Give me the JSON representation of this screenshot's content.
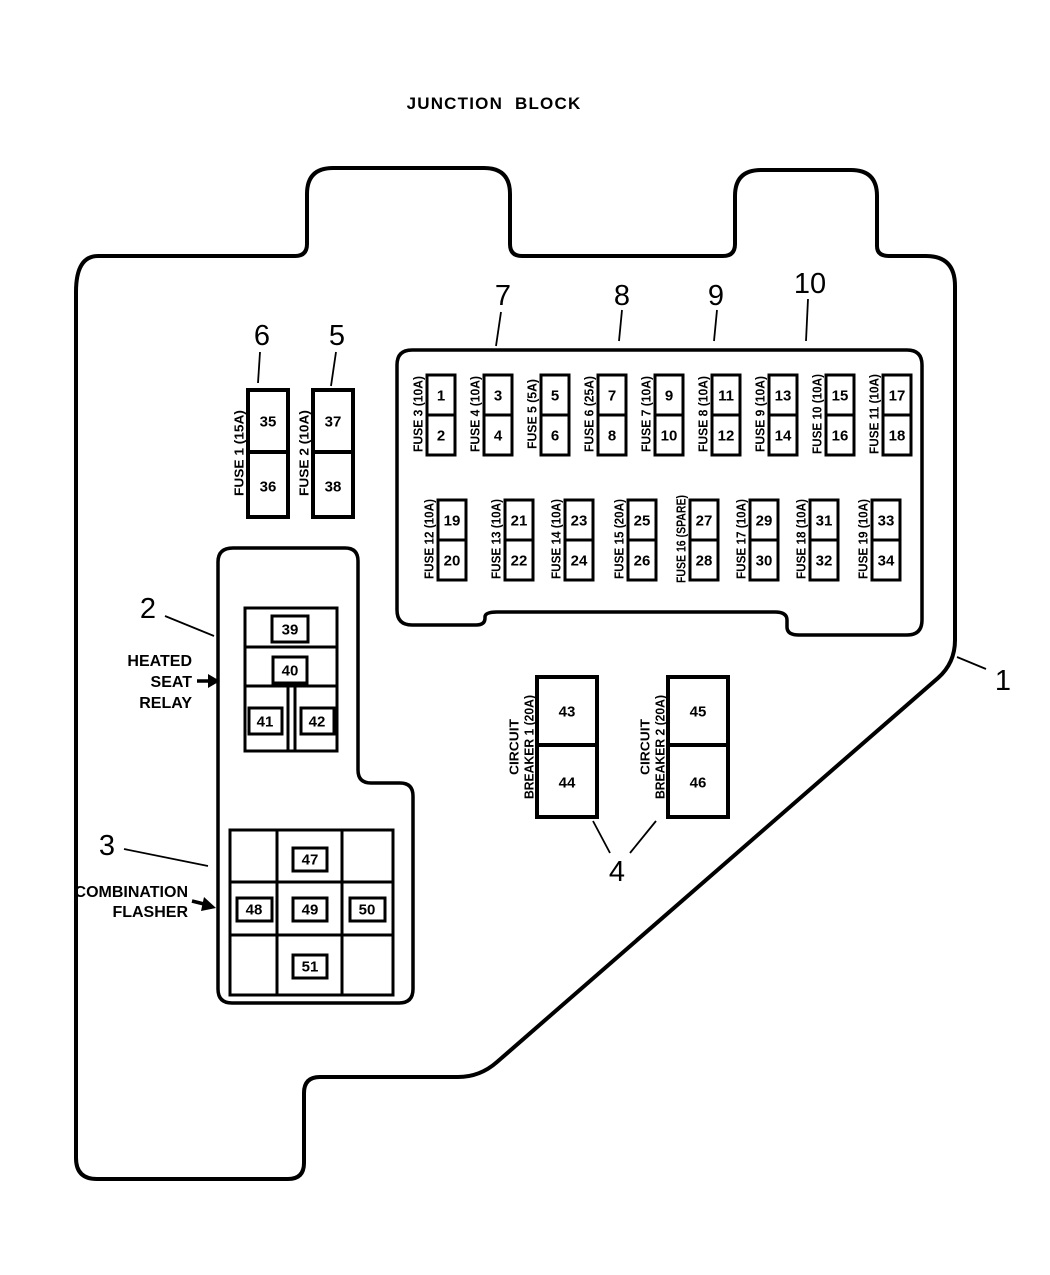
{
  "title": "JUNCTION BLOCK",
  "callouts": {
    "c1": "1",
    "c2": "2",
    "c3": "3",
    "c4": "4",
    "c5": "5",
    "c6": "6",
    "c7": "7",
    "c8": "8",
    "c9": "9",
    "c10": "10"
  },
  "left_fuses": [
    {
      "label": "FUSE 1 (15A)",
      "top": "35",
      "bottom": "36"
    },
    {
      "label": "FUSE 2 (10A)",
      "top": "37",
      "bottom": "38"
    }
  ],
  "fuse_block": {
    "row1": [
      {
        "label": "FUSE 3 (10A)",
        "top": "1",
        "bottom": "2"
      },
      {
        "label": "FUSE 4 (10A)",
        "top": "3",
        "bottom": "4"
      },
      {
        "label": "FUSE 5 (5A)",
        "top": "5",
        "bottom": "6"
      },
      {
        "label": "FUSE 6 (25A)",
        "top": "7",
        "bottom": "8"
      },
      {
        "label": "FUSE 7 (10A)",
        "top": "9",
        "bottom": "10"
      },
      {
        "label": "FUSE 8 (10A)",
        "top": "11",
        "bottom": "12"
      },
      {
        "label": "FUSE 9 (10A)",
        "top": "13",
        "bottom": "14"
      },
      {
        "label": "FUSE 10 (10A)",
        "top": "15",
        "bottom": "16"
      },
      {
        "label": "FUSE 11 (10A)",
        "top": "17",
        "bottom": "18"
      }
    ],
    "row2": [
      {
        "label": "FUSE 12 (10A)",
        "top": "19",
        "bottom": "20"
      },
      {
        "label": "FUSE 13 (10A)",
        "top": "21",
        "bottom": "22"
      },
      {
        "label": "FUSE 14 (10A)",
        "top": "23",
        "bottom": "24"
      },
      {
        "label": "FUSE 15 (20A)",
        "top": "25",
        "bottom": "26"
      },
      {
        "label": "FUSE 16 (SPARE)",
        "top": "27",
        "bottom": "28"
      },
      {
        "label": "FUSE 17 (10A)",
        "top": "29",
        "bottom": "30"
      },
      {
        "label": "FUSE 18 (10A)",
        "top": "31",
        "bottom": "32"
      },
      {
        "label": "FUSE 19 (10A)",
        "top": "33",
        "bottom": "34"
      }
    ]
  },
  "relay": {
    "line1": "HEATED",
    "line2": "SEAT",
    "line3": "RELAY",
    "cells": [
      "39",
      "40",
      "41",
      "42"
    ]
  },
  "flasher": {
    "line1": "COMBINATION",
    "line2": "FLASHER",
    "cells": [
      "47",
      "48",
      "49",
      "50",
      "51"
    ]
  },
  "breakers": [
    {
      "label_top": "CIRCUIT",
      "label_bottom": "BREAKER 1 (20A)",
      "top": "43",
      "bottom": "44"
    },
    {
      "label_top": "CIRCUIT",
      "label_bottom": "BREAKER 2 (20A)",
      "top": "45",
      "bottom": "46"
    }
  ]
}
